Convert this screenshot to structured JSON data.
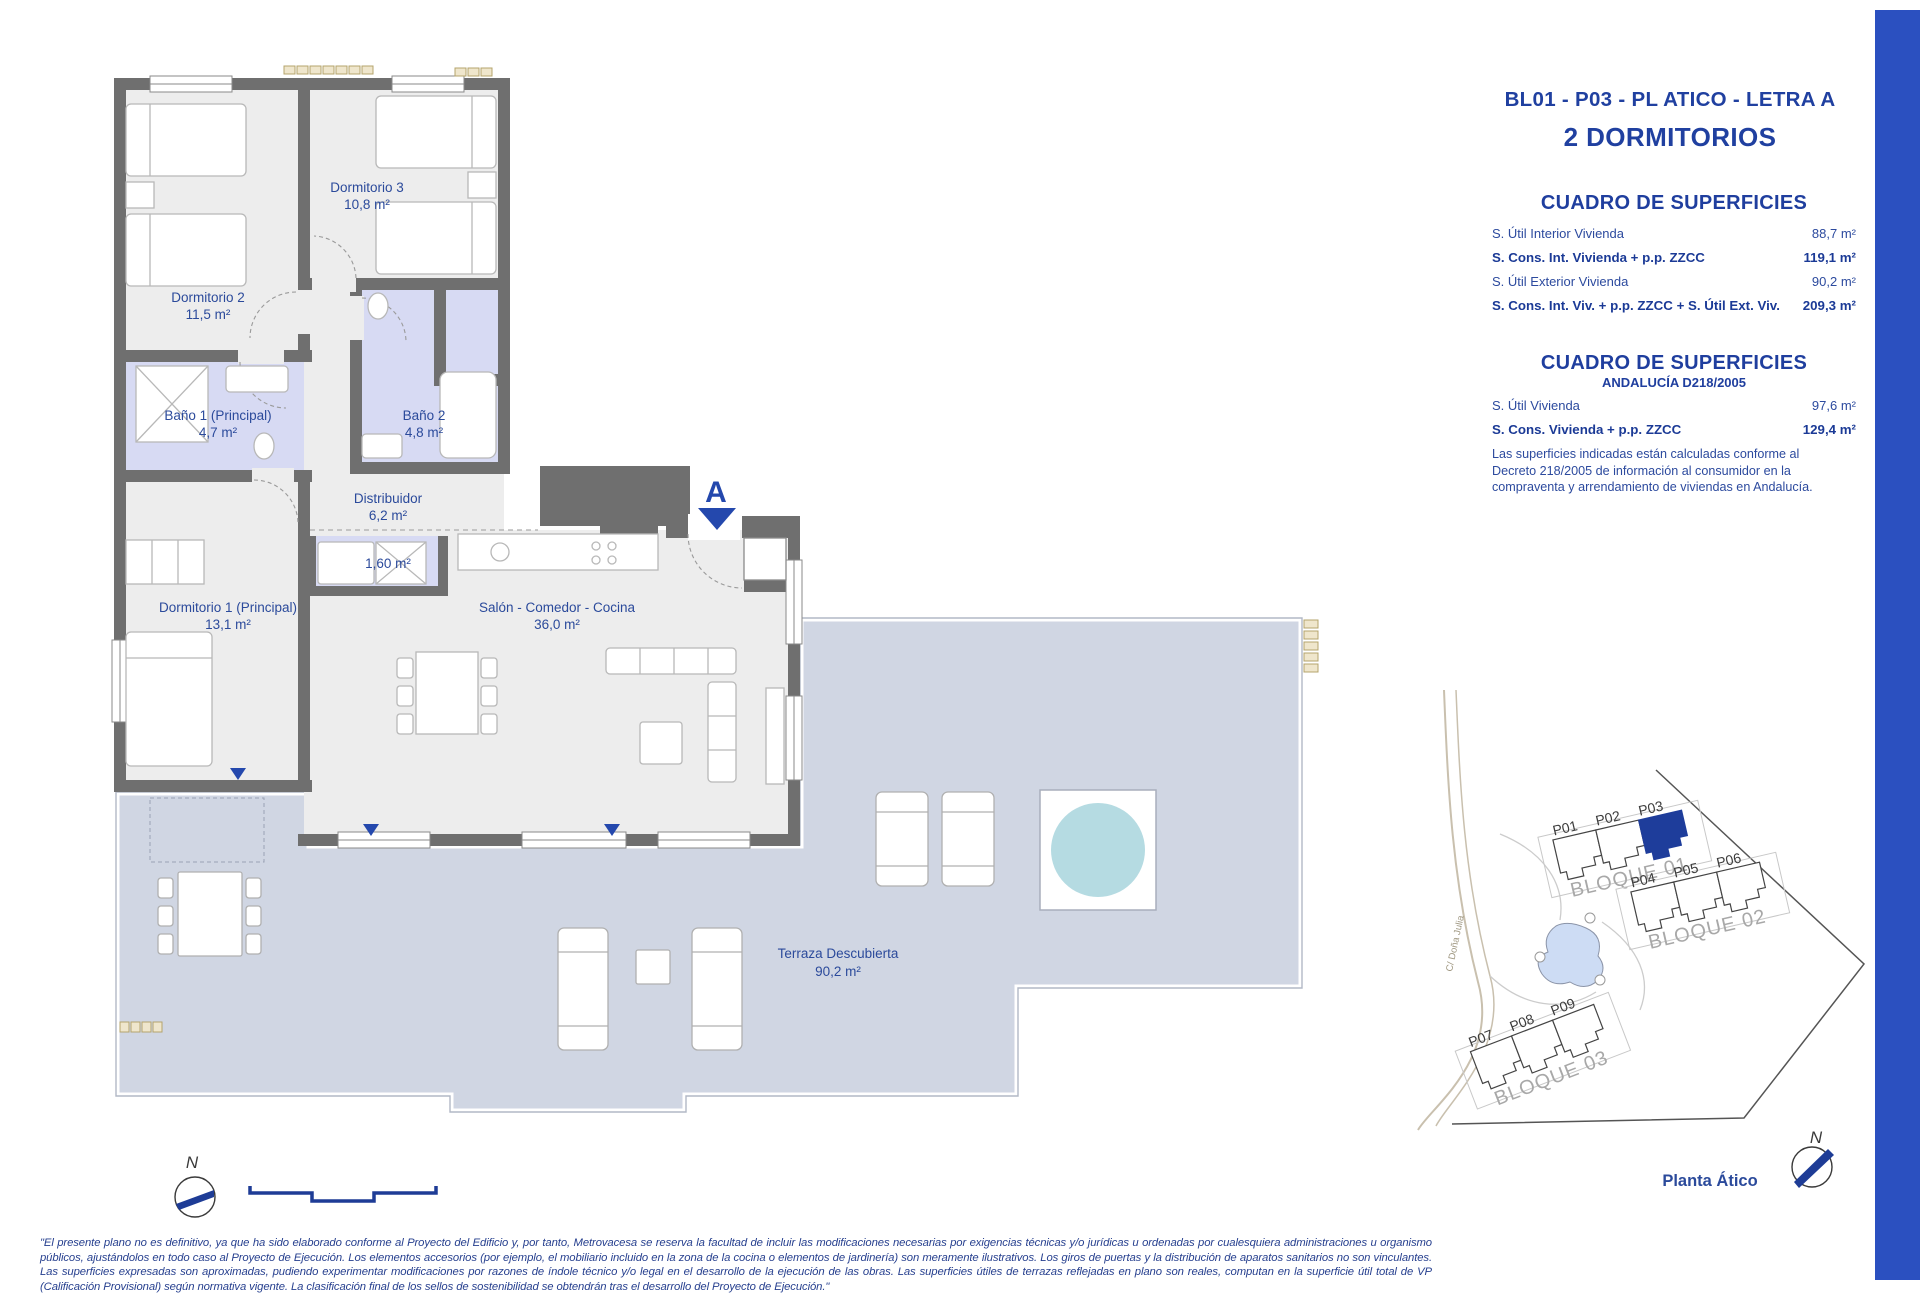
{
  "header": {
    "unit_code": "BL01 - P03 - PL ATICO - LETRA A",
    "bedrooms": "2 DORMITORIOS"
  },
  "surfaces_table_1": {
    "title": "CUADRO DE SUPERFICIES",
    "rows": [
      {
        "label": "S. Útil Interior Vivienda",
        "value": "88,7 m²"
      },
      {
        "label": "S. Cons. Int. Vivienda + p.p. ZZCC",
        "value": "119,1 m²"
      },
      {
        "label": "S. Útil Exterior Vivienda",
        "value": "90,2 m²"
      },
      {
        "label": "S. Cons. Int. Viv. + p.p. ZZCC + S. Útil Ext. Viv.",
        "value": "209,3 m²"
      }
    ]
  },
  "surfaces_table_2": {
    "title": "CUADRO DE SUPERFICIES",
    "subtitle": "ANDALUCÍA D218/2005",
    "rows": [
      {
        "label": "S. Útil Vivienda",
        "value": "97,6 m²"
      },
      {
        "label": "S. Cons. Vivienda + p.p. ZZCC",
        "value": "129,4 m²"
      }
    ],
    "note": "Las superficies indicadas están calculadas conforme al Decreto 218/2005 de información al consumidor en la compraventa y arrendamiento de viviendas en Andalucía."
  },
  "floor_plan": {
    "rooms": [
      {
        "name": "Dormitorio 3",
        "area": "10,8 m²"
      },
      {
        "name": "Dormitorio 2",
        "area": "11,5 m²"
      },
      {
        "name": "Baño 1 (Principal)",
        "area": "4,7 m²"
      },
      {
        "name": "Baño 2",
        "area": "4,8 m²"
      },
      {
        "name": "Distribuidor",
        "area": "6,2 m²"
      },
      {
        "name": "",
        "area": "1,60 m²"
      },
      {
        "name": "Dormitorio 1 (Principal)",
        "area": "13,1 m²"
      },
      {
        "name": "Salón - Comedor - Cocina",
        "area": "36,0 m²"
      },
      {
        "name": "Terraza Descubierta",
        "area": "90,2 m²"
      }
    ],
    "section_marker": "A"
  },
  "site_plan": {
    "blocks": [
      "BLOQUE 01",
      "BLOQUE 02",
      "BLOQUE 03"
    ],
    "units": [
      "P01",
      "P02",
      "P03",
      "P04",
      "P05",
      "P06",
      "P07",
      "P08",
      "P09"
    ],
    "highlighted_unit": "P03",
    "street": "C/ Doña Julia",
    "caption": "Planta Ático"
  },
  "compass": {
    "north_label": "N"
  },
  "footer": {
    "disclaimer": "\"El presente plano no es definitivo, ya que ha sido elaborado conforme al Proyecto del Edificio y, por tanto, Metrovacesa se reserva la facultad de incluir las modificaciones necesarias por exigencias técnicas y/o jurídicas u ordenadas por cualesquiera administraciones u organismo públicos, ajustándolos en todo caso al Proyecto de Ejecución. Los elementos accesorios (por ejemplo, el mobiliario incluido en la zona de la cocina o elementos de jardinería) son meramente ilustrativos. Los giros de puertas y la distribución de aparatos sanitarios no son vinculantes. Las superficies expresadas son aproximadas, pudiendo experimentar modificaciones por razones de índole técnico y/o legal en el desarrollo de la ejecución de las obras. Las superficies útiles de terrazas reflejadas en plano son reales, computan en la superficie útil total de VP (Calificación Provisional) según normativa vigente. La clasificación final de los sellos de sostenibilidad se obtendrán tras el desarrollo del Proyecto de Ejecución.\""
  },
  "colors": {
    "accent_blue": "#2b50c0",
    "navy_text": "#2343a0",
    "wall_gray": "#6f6f6f",
    "bath_lavender": "#d7daf3",
    "terrace_blue_gray": "#d0d6e3",
    "pool_teal": "#b5dbe2",
    "highlight_unit_navy": "#1e3d9b"
  }
}
